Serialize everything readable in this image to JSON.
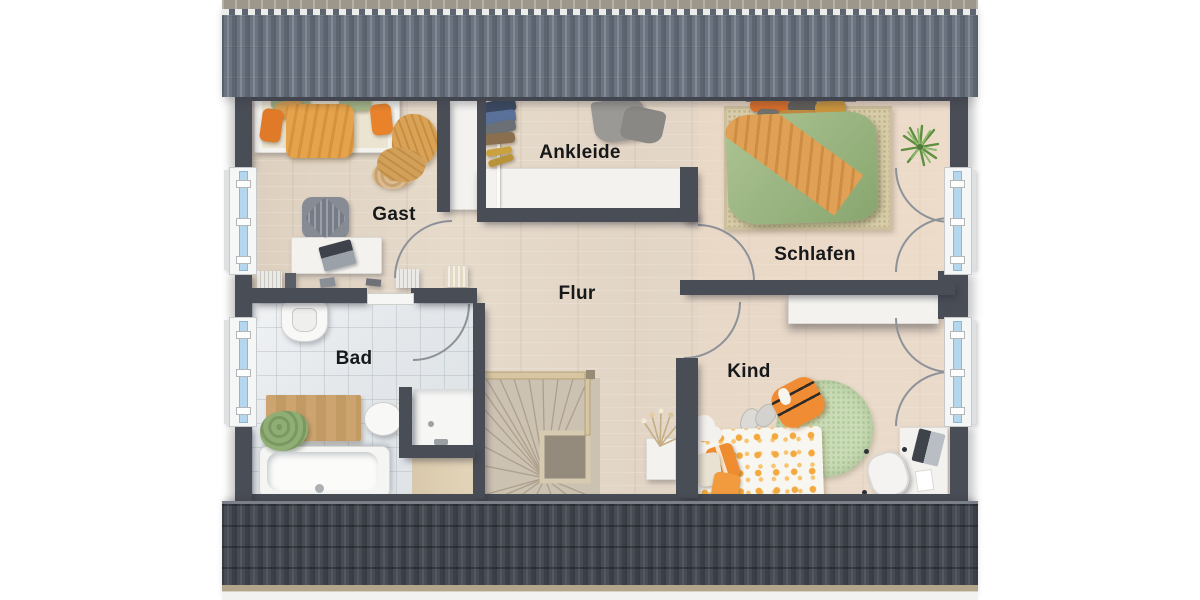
{
  "rooms": [
    {
      "id": "gast",
      "label": "Gast"
    },
    {
      "id": "ankleide",
      "label": "Ankleide"
    },
    {
      "id": "schlafen",
      "label": "Schlafen"
    },
    {
      "id": "flur",
      "label": "Flur"
    },
    {
      "id": "bad",
      "label": "Bad"
    },
    {
      "id": "kind",
      "label": "Kind"
    }
  ],
  "palette": {
    "wall": "#494d56",
    "roof_top": "#6b7480",
    "roof_ridge": "#9d978b",
    "roof_bottom": "#43474f",
    "wood_floor": "#e2d5c5",
    "tile_floor": "#e4e7ea",
    "window_glass": "#b5d7ee",
    "duvet_green": "#a2bd8a",
    "accent_orange": "#ec8b33",
    "deep_orange": "#d96f2b",
    "mustard": "#d9a254",
    "rug_green": "#c8dcb4",
    "rug_beige": "#d8cca8",
    "label_text": "#17181a"
  }
}
